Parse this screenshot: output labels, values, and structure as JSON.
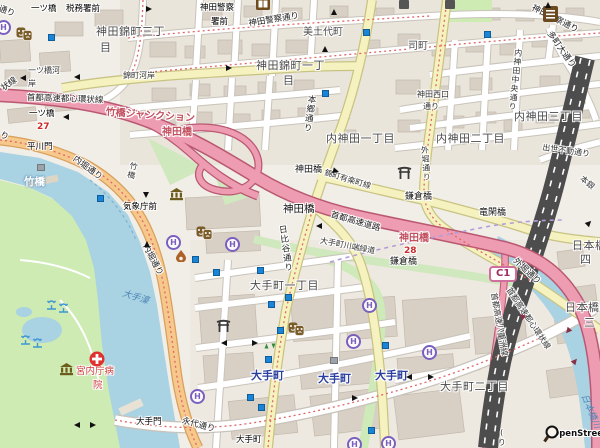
{
  "map": {
    "attribution": "OpenStreetMap",
    "hotel_letter": "H",
    "colors": {
      "land": "#f1eee7",
      "block": "#eae5db",
      "building": "#d8cfc5",
      "water": "#a9d2e3",
      "park": "#cdebb2",
      "motorway": "#ee9cb1",
      "primary": "#f6c88c",
      "secondary": "#f6f2c0",
      "rail": "#4d4d4d",
      "subway_marker": "#1a85d6",
      "hotel_icon": "#7a5fc0",
      "junction_red": "#c2505f",
      "station_blue": "#2b3f9e"
    },
    "labels": [
      {
        "t": "通り",
        "x": 0,
        "y": 5,
        "c": "road",
        "r": 20
      },
      {
        "t": "一ツ橋",
        "x": 31,
        "y": 5,
        "c": "bus"
      },
      {
        "t": "税務署前",
        "x": 66,
        "y": 5,
        "c": "bus"
      },
      {
        "t": "神田警察",
        "x": 200,
        "y": 4,
        "c": "bus"
      },
      {
        "t": "署前",
        "x": 211,
        "y": 18,
        "c": "bus"
      },
      {
        "t": "神田警察通り",
        "x": 248,
        "y": 20,
        "c": "road",
        "r": -9
      },
      {
        "t": "美土代町",
        "x": 303,
        "y": 27,
        "c": "area-sm"
      },
      {
        "t": "神田警察通り",
        "x": 534,
        "y": 4,
        "c": "road",
        "r": 27
      },
      {
        "t": "多町大通り",
        "x": 552,
        "y": 30,
        "c": "road",
        "r": 55
      },
      {
        "t": "神田錦町三丁",
        "x": 96,
        "y": 26,
        "c": "area"
      },
      {
        "t": "目",
        "x": 100,
        "y": 42,
        "c": "area"
      },
      {
        "t": "司町",
        "x": 408,
        "y": 41,
        "c": "area-sm"
      },
      {
        "t": "神田錦町一丁",
        "x": 256,
        "y": 60,
        "c": "area"
      },
      {
        "t": "目",
        "x": 283,
        "y": 75,
        "c": "area"
      },
      {
        "t": "本郷通り",
        "x": 306,
        "y": 94,
        "c": "road vert",
        "r": 8
      },
      {
        "t": "一ツ橋河",
        "x": 28,
        "y": 66,
        "c": "road-sm"
      },
      {
        "t": "岸",
        "x": 28,
        "y": 79,
        "c": "road-sm"
      },
      {
        "t": "錦町河岸",
        "x": 123,
        "y": 71,
        "c": "road-sm"
      },
      {
        "t": "状線",
        "x": 0,
        "y": 86,
        "c": "road",
        "r": -35
      },
      {
        "t": "首都高速都心環状線",
        "x": 27,
        "y": 94,
        "c": "road",
        "r": 2
      },
      {
        "t": "竹橋ジャンクション",
        "x": 106,
        "y": 107,
        "c": "red-jct",
        "r": 4
      },
      {
        "t": "一ツ橋",
        "x": 29,
        "y": 110,
        "c": "bus"
      },
      {
        "t": "27",
        "x": 37,
        "y": 122,
        "c": "exit"
      },
      {
        "t": "神田橋",
        "x": 162,
        "y": 127,
        "c": "red-jct"
      },
      {
        "t": "り",
        "x": 2,
        "y": 131,
        "c": "road",
        "r": 25
      },
      {
        "t": "平川門",
        "x": 27,
        "y": 143,
        "c": "bus"
      },
      {
        "t": "内神田一丁目",
        "x": 326,
        "y": 133,
        "c": "area"
      },
      {
        "t": "内神田二丁目",
        "x": 436,
        "y": 133,
        "c": "area"
      },
      {
        "t": "内神田三丁目",
        "x": 514,
        "y": 111,
        "c": "area"
      },
      {
        "t": "神田西口",
        "x": 417,
        "y": 90,
        "c": "road-sm"
      },
      {
        "t": "通り",
        "x": 423,
        "y": 102,
        "c": "road-sm"
      },
      {
        "t": "内神田中央通り",
        "x": 514,
        "y": 48,
        "c": "road-sm vert",
        "r": 6
      },
      {
        "t": "出世不動通り",
        "x": 543,
        "y": 143,
        "c": "road-sm",
        "r": 8
      },
      {
        "t": "内堀通り",
        "x": 76,
        "y": 155,
        "c": "road",
        "r": 36
      },
      {
        "t": "竹橋",
        "x": 130,
        "y": 161,
        "c": "road-sm vert",
        "r": 14
      },
      {
        "t": "竹橋",
        "x": 24,
        "y": 176,
        "c": "white-st"
      },
      {
        "t": "気象庁前",
        "x": 123,
        "y": 203,
        "c": "bus"
      },
      {
        "t": "神田橋",
        "x": 295,
        "y": 165,
        "c": "bridge"
      },
      {
        "t": "錦町有楽町線",
        "x": 326,
        "y": 168,
        "c": "road-sm",
        "r": 17
      },
      {
        "t": "鎌倉橋",
        "x": 405,
        "y": 192,
        "c": "bridge"
      },
      {
        "t": "神田橋",
        "x": 283,
        "y": 203,
        "c": "bridge-lg"
      },
      {
        "t": "首都高速道路",
        "x": 332,
        "y": 211,
        "c": "road",
        "r": 16
      },
      {
        "t": "竜閑橋",
        "x": 479,
        "y": 208,
        "c": "bridge"
      },
      {
        "t": "本銀",
        "x": 584,
        "y": 174,
        "c": "road-sm",
        "r": 40
      },
      {
        "t": "外堀通り",
        "x": 420,
        "y": 146,
        "c": "road-sm vert",
        "r": -4
      },
      {
        "t": "神田橋",
        "x": 399,
        "y": 233,
        "c": "red-jct"
      },
      {
        "t": "28",
        "x": 404,
        "y": 246,
        "c": "exit"
      },
      {
        "t": "鎌倉橋",
        "x": 390,
        "y": 257,
        "c": "bridge"
      },
      {
        "t": "日比谷通り",
        "x": 276,
        "y": 226,
        "c": "road vert",
        "r": -8
      },
      {
        "t": "大手町川端緑道",
        "x": 321,
        "y": 236,
        "c": "road-sm",
        "r": 11
      },
      {
        "t": "日本橋",
        "x": 572,
        "y": 240,
        "c": "area"
      },
      {
        "t": "四",
        "x": 580,
        "y": 254,
        "c": "area"
      },
      {
        "t": "C1",
        "x": 489,
        "y": 266,
        "c": "shield"
      },
      {
        "t": "外堀通り",
        "x": 517,
        "y": 257,
        "c": "road",
        "r": 43
      },
      {
        "t": "内堀通り",
        "x": 148,
        "y": 243,
        "c": "road",
        "r": 62
      },
      {
        "t": "大手濠",
        "x": 124,
        "y": 289,
        "c": "water-lbl",
        "r": 17
      },
      {
        "t": "大手町一丁目",
        "x": 250,
        "y": 280,
        "c": "area"
      },
      {
        "t": "日本橋",
        "x": 565,
        "y": 302,
        "c": "area"
      },
      {
        "t": "三",
        "x": 584,
        "y": 317,
        "c": "area"
      },
      {
        "t": "首都高速都心環状線",
        "x": 512,
        "y": 286,
        "c": "road-sm",
        "r": 56
      },
      {
        "t": "首都高速八重洲線",
        "x": 498,
        "y": 292,
        "c": "road-sm",
        "r": 80
      },
      {
        "t": "大手町",
        "x": 251,
        "y": 370,
        "c": "station"
      },
      {
        "t": "大手町",
        "x": 318,
        "y": 373,
        "c": "station"
      },
      {
        "t": "大手町",
        "x": 375,
        "y": 370,
        "c": "station"
      },
      {
        "t": "大手町二丁目",
        "x": 440,
        "y": 381,
        "c": "area"
      },
      {
        "t": "宮内庁病",
        "x": 76,
        "y": 367,
        "c": "hosp"
      },
      {
        "t": "院",
        "x": 93,
        "y": 381,
        "c": "hosp"
      },
      {
        "t": "大手門",
        "x": 136,
        "y": 418,
        "c": "bus"
      },
      {
        "t": "永代通り",
        "x": 183,
        "y": 417,
        "c": "road",
        "r": 15
      },
      {
        "t": "大手町",
        "x": 236,
        "y": 436,
        "c": "bus"
      },
      {
        "t": "日本橋川",
        "x": 588,
        "y": 393,
        "c": "water-lbl",
        "r": 68
      },
      {
        "t": "(り",
        "x": 497,
        "y": 428,
        "c": "road-sm vert"
      },
      {
        "t": "OpenStreetMap",
        "x": 552,
        "y": 430,
        "c": "osm"
      }
    ],
    "icons": [
      {
        "n": "hotel",
        "x": -4,
        "y": 20
      },
      {
        "n": "hotel",
        "x": 166,
        "y": 235
      },
      {
        "n": "hotel",
        "x": 225,
        "y": 237
      },
      {
        "n": "hotel",
        "x": 362,
        "y": 298
      },
      {
        "n": "hotel",
        "x": 346,
        "y": 334
      },
      {
        "n": "hotel",
        "x": 422,
        "y": 345
      },
      {
        "n": "hotel",
        "x": 190,
        "y": 389
      },
      {
        "n": "hotel",
        "x": 347,
        "y": 437
      },
      {
        "n": "hotel",
        "x": 381,
        "y": 436
      },
      {
        "n": "museum",
        "x": 169,
        "y": 188
      },
      {
        "n": "museum",
        "x": 59,
        "y": 363
      },
      {
        "n": "theater",
        "x": 16,
        "y": 27
      },
      {
        "n": "theater",
        "x": 196,
        "y": 226
      },
      {
        "n": "theater",
        "x": 288,
        "y": 322
      },
      {
        "n": "torii",
        "x": 397,
        "y": 166
      },
      {
        "n": "torii",
        "x": 216,
        "y": 319
      },
      {
        "n": "library",
        "x": 256,
        "y": -2
      },
      {
        "n": "shop",
        "x": 543,
        "y": 6
      },
      {
        "n": "dark",
        "x": 399,
        "y": 0
      },
      {
        "n": "dark",
        "x": 445,
        "y": 0
      },
      {
        "n": "hospital",
        "x": 89,
        "y": 351
      },
      {
        "n": "flame",
        "x": 175,
        "y": 250
      },
      {
        "n": "fountain",
        "x": 46,
        "y": 300
      },
      {
        "n": "fountain",
        "x": 58,
        "y": 303
      },
      {
        "n": "fountain",
        "x": 20,
        "y": 335
      },
      {
        "n": "fountain",
        "x": 32,
        "y": 338
      },
      {
        "n": "graysq",
        "x": 37,
        "y": 164
      },
      {
        "n": "graysq",
        "x": 330,
        "y": 357
      },
      {
        "n": "osm-magnifier",
        "x": 543,
        "y": 425
      }
    ],
    "subway_entrances": [
      [
        48,
        34
      ],
      [
        363,
        29
      ],
      [
        322,
        90
      ],
      [
        484,
        31
      ],
      [
        97,
        195
      ],
      [
        192,
        256
      ],
      [
        213,
        269
      ],
      [
        257,
        267
      ],
      [
        285,
        294
      ],
      [
        268,
        301
      ],
      [
        277,
        327
      ],
      [
        265,
        356
      ],
      [
        247,
        394
      ],
      [
        258,
        404
      ],
      [
        382,
        342
      ],
      [
        368,
        427
      ]
    ],
    "arrows": [
      [
        20,
        75,
        180,
        ""
      ],
      [
        74,
        74,
        180,
        ""
      ],
      [
        146,
        6,
        0,
        ""
      ],
      [
        331,
        9,
        -90,
        ""
      ],
      [
        322,
        46,
        -90,
        ""
      ],
      [
        226,
        65,
        0,
        ""
      ],
      [
        63,
        114,
        180,
        ""
      ],
      [
        143,
        192,
        90,
        ""
      ],
      [
        144,
        241,
        -90,
        ""
      ],
      [
        316,
        223,
        180,
        ""
      ],
      [
        545,
        2,
        -90,
        ""
      ],
      [
        352,
        395,
        0,
        ""
      ],
      [
        406,
        374,
        180,
        ""
      ],
      [
        428,
        374,
        0,
        ""
      ],
      [
        74,
        422,
        180,
        ""
      ],
      [
        90,
        422,
        0,
        ""
      ],
      [
        221,
        340,
        180,
        ""
      ],
      [
        252,
        340,
        0,
        ""
      ],
      [
        333,
        168,
        15,
        ""
      ],
      [
        586,
        220,
        315,
        ""
      ],
      [
        565,
        328,
        130,
        "red"
      ],
      [
        572,
        358,
        310,
        "red"
      ],
      [
        519,
        313,
        220,
        "red"
      ],
      [
        264,
        344,
        -90,
        "green"
      ],
      [
        271,
        344,
        90,
        "green"
      ]
    ]
  }
}
